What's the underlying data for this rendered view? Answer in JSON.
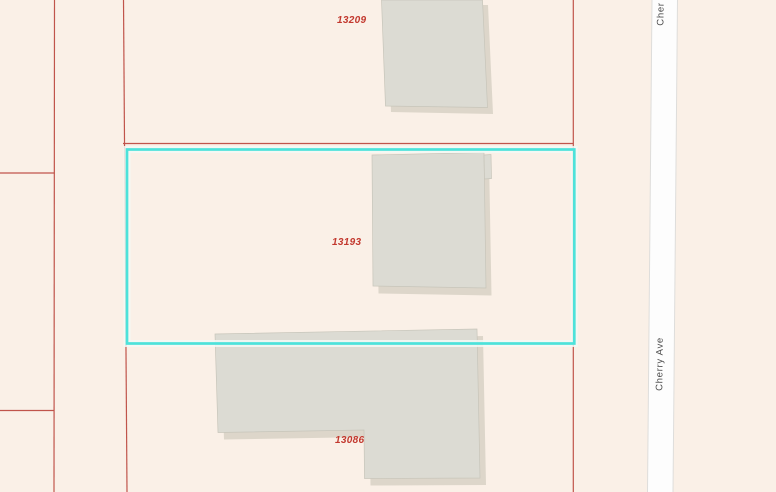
{
  "app": {
    "view": "gis-parcel-map"
  },
  "map": {
    "background_color": "#faf0e7",
    "parcel_line_color": "#c0544b",
    "parcel_label_color": "#c2382e",
    "selection_color": "#4ce2da",
    "selection_halo_color": "#f2f9f5",
    "building_fill_color": "#dcdbd3",
    "building_shadow_color": "#d7d1c4",
    "street_fill_color": "#fdfdfd",
    "street_edge_color": "#dedddb",
    "street_label_color": "#4a4a4a"
  },
  "parcels": [
    {
      "id": "13209",
      "label": "13209",
      "selected": false
    },
    {
      "id": "13193",
      "label": "13193",
      "selected": true
    },
    {
      "id": "13086",
      "label": "13086",
      "selected": false
    }
  ],
  "street": {
    "label": "Cherry Ave",
    "label_top": "Cher"
  }
}
